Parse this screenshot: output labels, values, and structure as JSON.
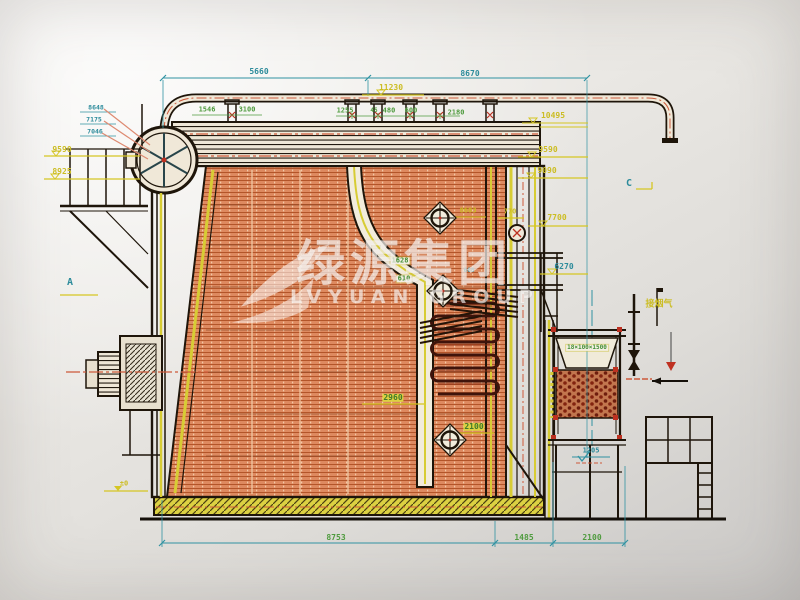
{
  "watermark": {
    "cn": "绿源集团",
    "en": "LVYUAN GROUP"
  },
  "colors": {
    "dim_teal": "#2a8c9c",
    "elev_yellow": "#cdbd1f",
    "dim_green": "#4d9c3c",
    "brick_hatch": "#e08a5e",
    "centerline_red": "#d05838",
    "coil_dark_red": "#7a2010",
    "insulation_yellow": "#d8cc30",
    "paper": "#eceae6"
  },
  "labels": [
    {
      "name": "dim-overall-left",
      "text": "5660",
      "x": 259,
      "y": 72,
      "c": "t"
    },
    {
      "name": "dim-overall-right",
      "text": "8670",
      "x": 470,
      "y": 74,
      "c": "t"
    },
    {
      "name": "dim-6270",
      "text": "6270",
      "x": 564,
      "y": 267,
      "c": "t"
    },
    {
      "name": "elev-1205",
      "text": "1205",
      "x": 591,
      "y": 451,
      "c": "t",
      "fs": 7
    },
    {
      "name": "section-marker-a",
      "text": "A",
      "x": 70,
      "y": 283,
      "c": "t",
      "fs": 10
    },
    {
      "name": "section-marker-c",
      "text": "C",
      "x": 629,
      "y": 184,
      "c": "t",
      "fs": 10
    },
    {
      "name": "dim-668",
      "text": "668",
      "x": 469,
      "y": 271,
      "c": "t",
      "fs": 6
    },
    {
      "name": "elev-8648",
      "text": "8648",
      "x": 96,
      "y": 108,
      "c": "t",
      "fs": 6.5
    },
    {
      "name": "elev-7175",
      "text": "7175",
      "x": 94,
      "y": 120,
      "c": "t",
      "fs": 6.5
    },
    {
      "name": "elev-7046",
      "text": "7046",
      "x": 95,
      "y": 132,
      "c": "t",
      "fs": 6.5
    },
    {
      "name": "elev-11230",
      "text": "11230",
      "x": 391,
      "y": 88,
      "c": "y"
    },
    {
      "name": "elev-10495",
      "text": "10495",
      "x": 553,
      "y": 116,
      "c": "y"
    },
    {
      "name": "elev-9590-right",
      "text": "9590",
      "x": 548,
      "y": 150,
      "c": "y"
    },
    {
      "name": "elev-9090",
      "text": "9090",
      "x": 547,
      "y": 171,
      "c": "y"
    },
    {
      "name": "dim-770",
      "text": "770",
      "x": 510,
      "y": 212,
      "c": "y",
      "fs": 7
    },
    {
      "name": "elev-7700",
      "text": "7700",
      "x": 557,
      "y": 218,
      "c": "y"
    },
    {
      "name": "dim-8603",
      "text": "8603",
      "x": 468,
      "y": 211,
      "c": "y",
      "fs": 7
    },
    {
      "name": "elev-9590-left",
      "text": "9590",
      "x": 62,
      "y": 150,
      "c": "y"
    },
    {
      "name": "elev-8925",
      "text": "8925",
      "x": 62,
      "y": 172,
      "c": "y"
    },
    {
      "name": "label-flue-outlet",
      "text": "接烟气",
      "x": 659,
      "y": 305,
      "c": "y",
      "fs": 9
    },
    {
      "name": "elev-zero",
      "text": "±0",
      "x": 124,
      "y": 484,
      "c": "y",
      "fs": 7
    },
    {
      "name": "dim-1546",
      "text": "1546",
      "x": 207,
      "y": 110,
      "c": "g",
      "fs": 7
    },
    {
      "name": "dim-3100",
      "text": "3100",
      "x": 247,
      "y": 110,
      "c": "g",
      "fs": 7
    },
    {
      "name": "dim-1255",
      "text": "1255",
      "x": 345,
      "y": 111,
      "c": "g",
      "fs": 7
    },
    {
      "name": "dim-45",
      "text": "45",
      "x": 374,
      "y": 111,
      "c": "g",
      "fs": 6
    },
    {
      "name": "dim-480",
      "text": "480",
      "x": 389,
      "y": 111,
      "c": "g",
      "fs": 7
    },
    {
      "name": "dim-600",
      "text": "600",
      "x": 411,
      "y": 111,
      "c": "g",
      "fs": 7
    },
    {
      "name": "dim-2180",
      "text": "2180",
      "x": 456,
      "y": 113,
      "c": "g",
      "fs": 7
    },
    {
      "name": "dim-8753",
      "text": "8753",
      "x": 336,
      "y": 538,
      "c": "g"
    },
    {
      "name": "dim-1485",
      "text": "1485",
      "x": 524,
      "y": 538,
      "c": "g"
    },
    {
      "name": "dim-2100-bottom",
      "text": "2100",
      "x": 592,
      "y": 538,
      "c": "g"
    },
    {
      "name": "dim-2960",
      "text": "2960",
      "x": 393,
      "y": 398,
      "c": "gy"
    },
    {
      "name": "dim-2100-mid",
      "text": "2100",
      "x": 474,
      "y": 427,
      "c": "gy"
    },
    {
      "name": "dim-1628",
      "text": "1628",
      "x": 400,
      "y": 261,
      "c": "gw",
      "fs": 7
    },
    {
      "name": "dim-610",
      "text": "610",
      "x": 404,
      "y": 279,
      "c": "gw",
      "fs": 7
    },
    {
      "name": "label-econ-spec",
      "text": "18×100×1500",
      "x": 587,
      "y": 348,
      "c": "gw",
      "fs": 6
    }
  ]
}
